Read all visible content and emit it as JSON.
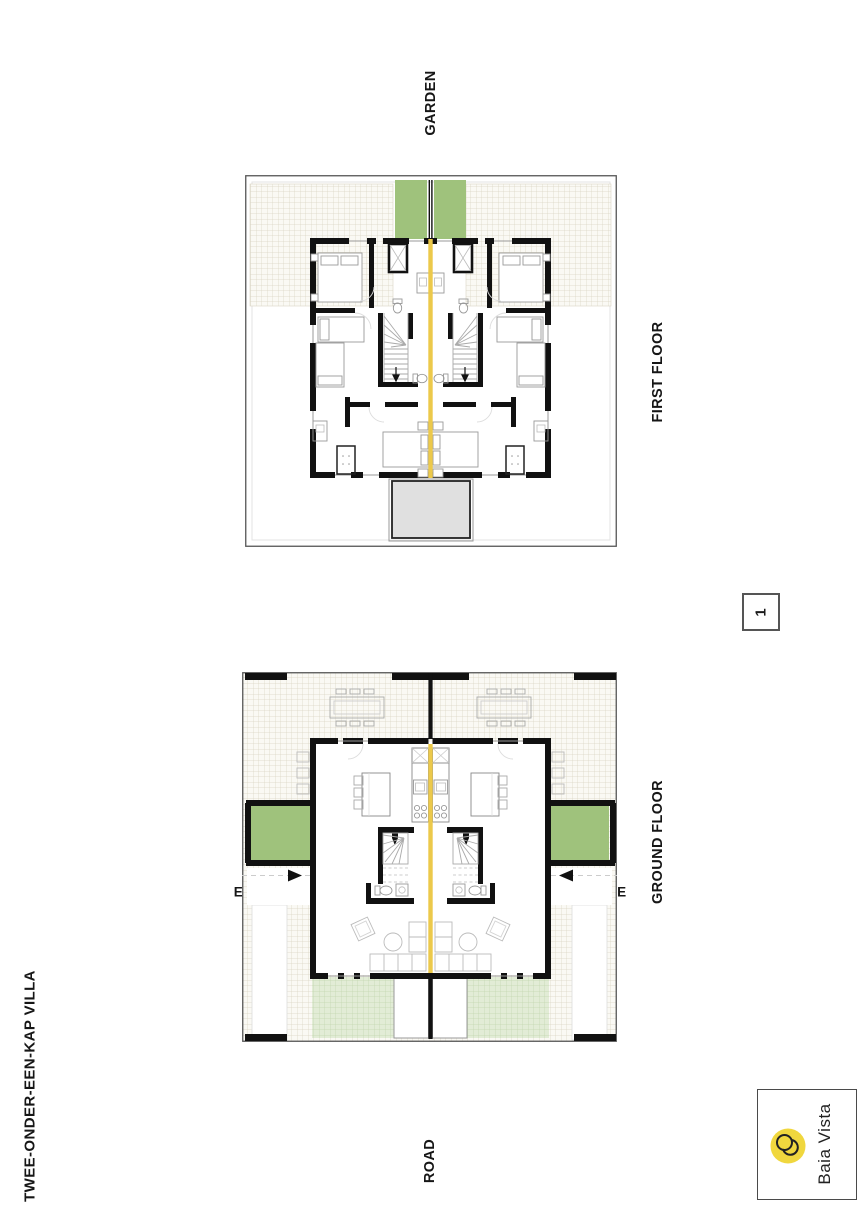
{
  "title": {
    "text": "TWEE-ONDER-EEN-KAP VILLA"
  },
  "labels": {
    "garden": "GARDEN",
    "road": "ROAD",
    "first_floor": "FIRST FLOOR",
    "ground_floor": "GROUND FLOOR",
    "entrance_left": "ENTRANCE",
    "entrance_right": "ENTRANCE"
  },
  "page_number": "1",
  "logo": {
    "text": "Baia Vista",
    "circle_color": "#f0d73e"
  },
  "colors": {
    "party_wall_yellow": "#ecc94b",
    "balcony_green": "#9fc27c",
    "front_terrace_green": "#e2ecd6",
    "roof_canopy_gray": "#e0e0e0",
    "wall_black": "#111111",
    "terrace_hatch_line": "#d9d4c3"
  }
}
